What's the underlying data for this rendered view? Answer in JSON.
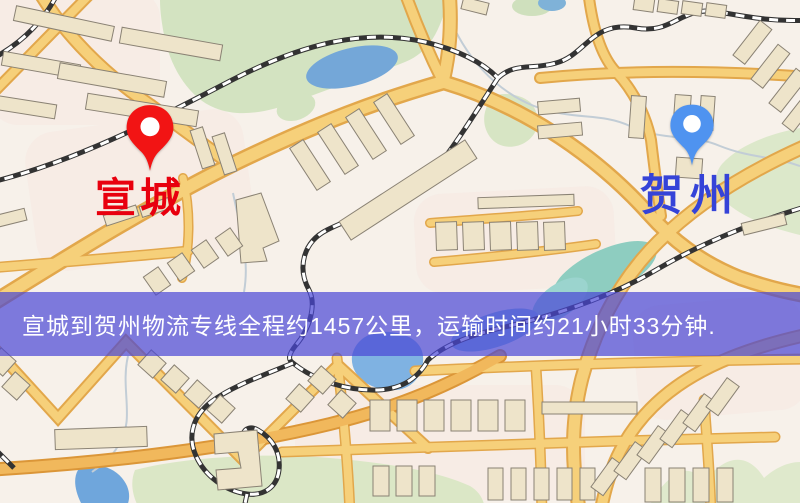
{
  "banner": {
    "text": "宣城到贺州物流专线全程约1457公里，运输时间约21小时33分钟.",
    "background_color": "rgba(72,70,214,0.70)",
    "text_color": "#ffffff"
  },
  "origin": {
    "label": "宣城",
    "label_color": "#e8000e",
    "pin_color": "#f21414",
    "pin_icon": "red-location-pin"
  },
  "destination": {
    "label": "贺州",
    "label_color": "#3543d8",
    "pin_color": "#4f93f0",
    "pin_icon": "blue-location-pin"
  },
  "map_palette": {
    "background": "#f7f1ea",
    "road_fill": "#f6d07a",
    "road_casing": "#e2a74b",
    "major_road_orange": "#f1b85c",
    "park_green": "#d3e3c1",
    "water_blue": "#74a7d8",
    "river_teal": "#8ecdc0",
    "railway_dark": "#333333",
    "building_fill": "#eee4ca",
    "building_stroke": "#8a8274"
  }
}
